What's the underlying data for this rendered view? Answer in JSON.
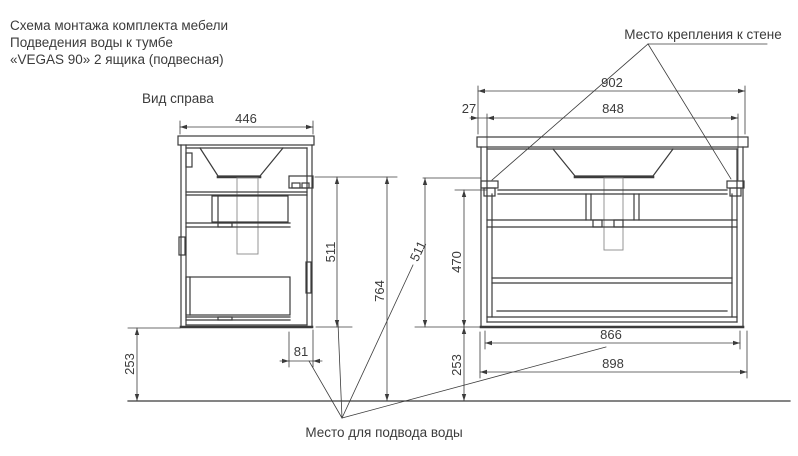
{
  "title_block": {
    "line1": "Схема монтажа комплекта мебели",
    "line2": "Подведения воды к тумбе",
    "line3": "«VEGAS 90» 2 ящика (подвесная)"
  },
  "view_labels": {
    "side_view": "Вид справа"
  },
  "callouts": {
    "wall_mount": "Место крепления к стене",
    "water_supply": "Место для подвода воды"
  },
  "dimensions_mm": {
    "side_view": {
      "depth": "446",
      "cabinet_height": "511",
      "wall_mount_height": "764",
      "floor_clearance": "253",
      "water_offset": "81"
    },
    "front_view": {
      "countertop_width": "902",
      "mount_edge_offset": "27",
      "mount_span": "848",
      "cabinet_height": "511",
      "inner_height": "470",
      "floor_clearance": "253",
      "bottom_inner_width": "866",
      "bottom_width": "898"
    }
  },
  "colors": {
    "background": "#ffffff",
    "line": "#3b3b3b",
    "text": "#3b3b3b",
    "secondary_line": "#8a8a8a"
  }
}
